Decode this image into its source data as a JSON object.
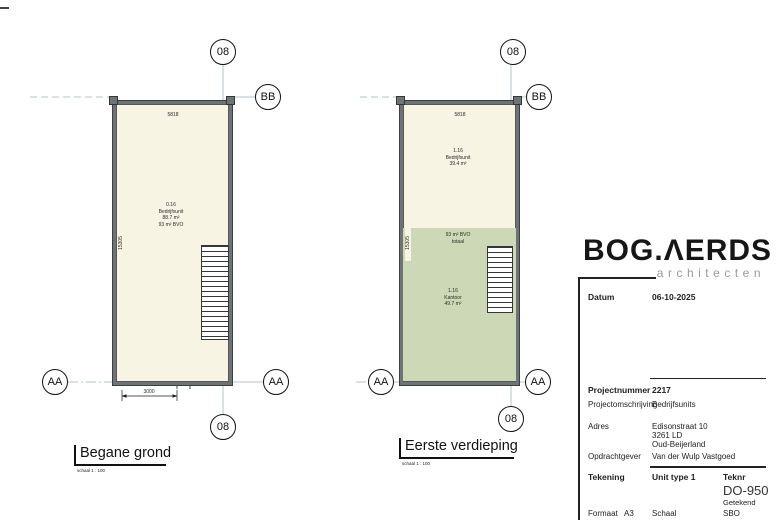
{
  "colors": {
    "room_fill": "#f8f4e3",
    "office_fill": "#cdd9b6",
    "wall": "#6e7376",
    "grid_line": "#b6c3ca",
    "logo_text_color": "#161616",
    "logo_sub_color": "#9b9b9b"
  },
  "plans": {
    "ground": {
      "title": "Begane grond",
      "scale_note": "schaal  1 : 100",
      "dims": {
        "width": "5818",
        "height": "15305",
        "door": "3000"
      },
      "room": {
        "number": "0.16",
        "name": "Bedrijfsunit",
        "area": "88.7 m²",
        "gross": "93 m² BVO"
      },
      "markers": {
        "top": "08",
        "bottom": "08",
        "right_top": "BB",
        "left": "AA",
        "right": "AA"
      }
    },
    "first": {
      "title": "Eerste verdieping",
      "scale_note": "schaal  1 : 100",
      "dims": {
        "width": "5818",
        "height": "15305"
      },
      "room_top": {
        "number": "1.16",
        "name": "Bedrijfsunit",
        "area": "39.4 m²"
      },
      "gross_note": {
        "line1": "93 m² BVO",
        "line2": "totaal"
      },
      "room_bottom": {
        "number": "1.16",
        "name": "Kantoor",
        "area": "49.7 m²"
      },
      "markers": {
        "top": "08",
        "bottom": "08",
        "right_top": "BB",
        "left": "AA",
        "right": "AA"
      }
    }
  },
  "titleblock": {
    "logo_text": "BOG",
    "logo_dot": ".",
    "logo_rest": "ΛERDS",
    "logo_sub": "architecten",
    "datum_label": "Datum",
    "datum_value": "06-10-2025",
    "projectnummer_label": "Projectnummer",
    "projectnummer_value": "2217",
    "omschrijving_label": "Projectomschrijving",
    "omschrijving_value": "Bedrijfsunits",
    "adres_label": "Adres",
    "adres_line1": "Edisonstraat 10",
    "adres_line2": "3261 LD",
    "adres_line3": "Oud-Beijerland",
    "opdrachtgever_label": "Opdrachtgever",
    "opdrachtgever_value": "Van der Wulp Vastgoed",
    "tekening_label": "Tekening",
    "tekening_value": "Unit type 1",
    "teknr_label": "Teknr",
    "teknr_value": "DO-950",
    "getekend_label": "Getekend",
    "getekend_value": "SBO",
    "formaat_label": "Formaat",
    "formaat_value": "A3",
    "schaal_label": "Schaal"
  }
}
